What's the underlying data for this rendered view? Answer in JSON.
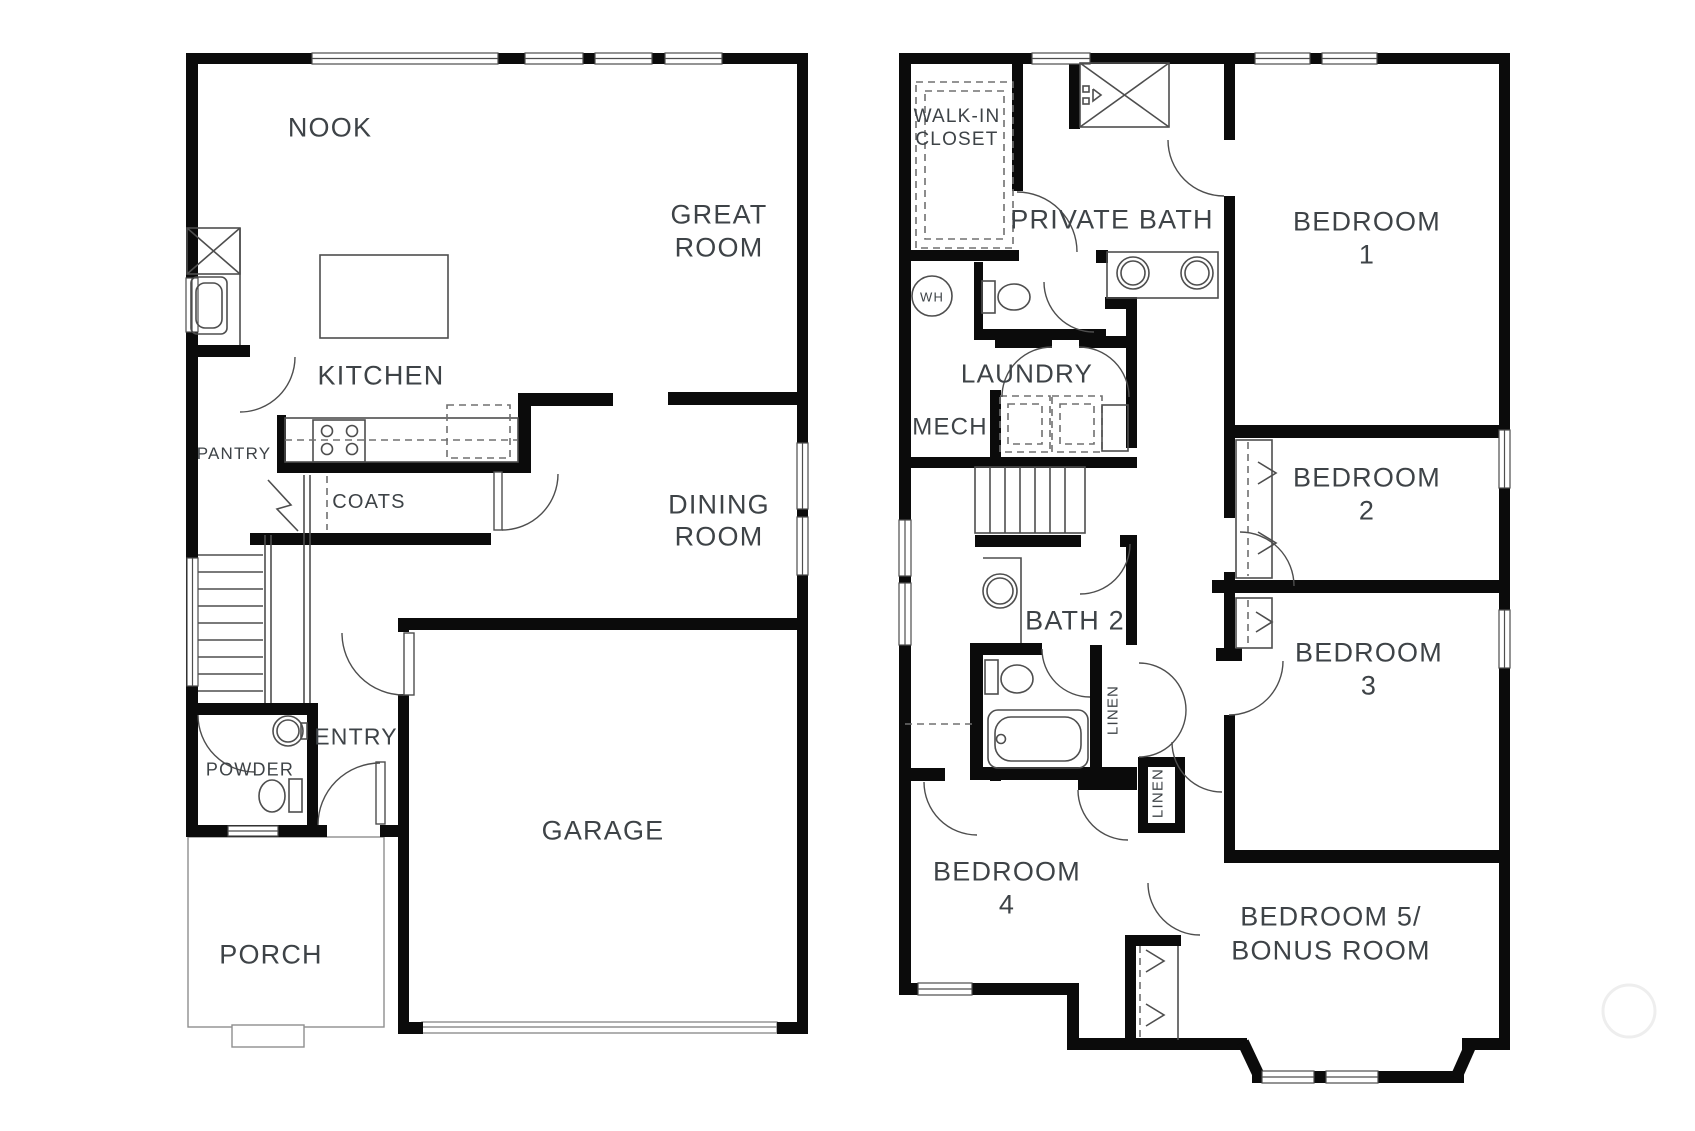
{
  "document": {
    "kind": "two-story house floor plan drawing"
  },
  "style": {
    "wall_color": "#0b0b0b",
    "fixture_line_color": "#4e4e4e",
    "light_line_color": "#8f8f8f",
    "dash_color": "#707070",
    "text_color": "#3e4347",
    "background_color": "#ffffff",
    "watermark_color": "#eeeeee"
  },
  "floors": [
    {
      "id": "first-floor",
      "labels": [
        {
          "name": "room-label-nook",
          "lines": [
            "NOOK"
          ],
          "x": 330,
          "y": 127,
          "size": 27,
          "lh": 33
        },
        {
          "name": "room-label-great-room",
          "lines": [
            "GREAT",
            "ROOM"
          ],
          "x": 719,
          "y": 214,
          "size": 27,
          "lh": 33
        },
        {
          "name": "room-label-kitchen",
          "lines": [
            "KITCHEN"
          ],
          "x": 381,
          "y": 375,
          "size": 27,
          "lh": 33
        },
        {
          "name": "room-label-pantry",
          "lines": [
            "PANTRY"
          ],
          "x": 234,
          "y": 453,
          "size": 17,
          "lh": 21
        },
        {
          "name": "room-label-coats",
          "lines": [
            "COATS"
          ],
          "x": 369,
          "y": 501,
          "size": 20,
          "lh": 24
        },
        {
          "name": "room-label-dining-room",
          "lines": [
            "DINING",
            "ROOM"
          ],
          "x": 719,
          "y": 504,
          "size": 27,
          "lh": 32
        },
        {
          "name": "room-label-powder",
          "lines": [
            "POWDER"
          ],
          "x": 250,
          "y": 769,
          "size": 18,
          "lh": 22
        },
        {
          "name": "room-label-entry",
          "lines": [
            "ENTRY"
          ],
          "x": 356,
          "y": 736,
          "size": 23,
          "lh": 27
        },
        {
          "name": "room-label-garage",
          "lines": [
            "GARAGE"
          ],
          "x": 603,
          "y": 830,
          "size": 27,
          "lh": 33
        },
        {
          "name": "room-label-porch",
          "lines": [
            "PORCH"
          ],
          "x": 271,
          "y": 954,
          "size": 27,
          "lh": 33
        }
      ]
    },
    {
      "id": "second-floor",
      "labels": [
        {
          "name": "room-label-walk-in-closet",
          "lines": [
            "WALK-IN",
            "CLOSET"
          ],
          "x": 957,
          "y": 115,
          "size": 19,
          "lh": 23
        },
        {
          "name": "room-label-private-bath",
          "lines": [
            "PRIVATE BATH"
          ],
          "x": 1112,
          "y": 219,
          "size": 27,
          "lh": 33
        },
        {
          "name": "room-label-bedroom-1",
          "lines": [
            "BEDROOM",
            "1"
          ],
          "x": 1367,
          "y": 221,
          "size": 27,
          "lh": 33
        },
        {
          "name": "label-water-heater",
          "lines": [
            "WH"
          ],
          "x": 932,
          "y": 297,
          "size": 13,
          "lh": 15
        },
        {
          "name": "room-label-laundry",
          "lines": [
            "LAUNDRY"
          ],
          "x": 1027,
          "y": 373,
          "size": 26,
          "lh": 31
        },
        {
          "name": "room-label-mech",
          "lines": [
            "MECH"
          ],
          "x": 950,
          "y": 426,
          "size": 24,
          "lh": 29
        },
        {
          "name": "room-label-bedroom-2",
          "lines": [
            "BEDROOM",
            "2"
          ],
          "x": 1367,
          "y": 477,
          "size": 27,
          "lh": 33
        },
        {
          "name": "room-label-bath-2",
          "lines": [
            "BATH 2"
          ],
          "x": 1075,
          "y": 620,
          "size": 27,
          "lh": 33
        },
        {
          "name": "room-label-linen-1",
          "lines": [
            "LINEN"
          ],
          "x": 1112,
          "y": 710,
          "size": 15,
          "lh": 18,
          "rot": -90
        },
        {
          "name": "room-label-bedroom-3",
          "lines": [
            "BEDROOM",
            "3"
          ],
          "x": 1369,
          "y": 652,
          "size": 27,
          "lh": 33
        },
        {
          "name": "room-label-linen-2",
          "lines": [
            "LINEN"
          ],
          "x": 1157,
          "y": 793,
          "size": 15,
          "lh": 18,
          "rot": -90
        },
        {
          "name": "room-label-bedroom-4",
          "lines": [
            "BEDROOM",
            "4"
          ],
          "x": 1007,
          "y": 871,
          "size": 27,
          "lh": 33
        },
        {
          "name": "room-label-bedroom-5-bonus",
          "lines": [
            "BEDROOM 5/",
            "BONUS ROOM"
          ],
          "x": 1331,
          "y": 916,
          "size": 27,
          "lh": 34
        }
      ]
    }
  ]
}
